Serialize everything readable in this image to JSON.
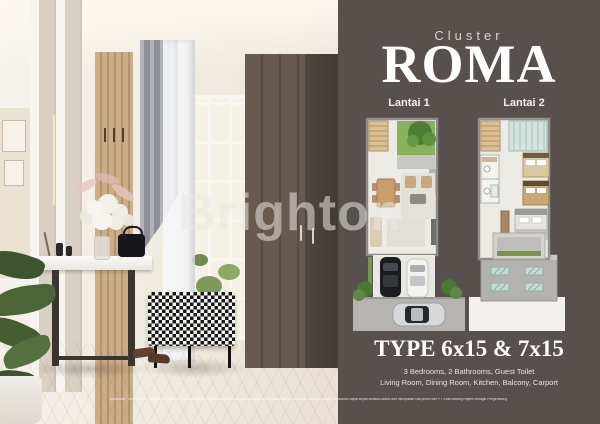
{
  "colors": {
    "panel_bg": "#57504d",
    "title_color": "#ffffff",
    "muted_label": "#d8d3ce",
    "garden_green": "#6f9a4c",
    "floor_wood": "#ddc9a2"
  },
  "watermark": {
    "text": "Brighton"
  },
  "panel": {
    "cluster_label": "Cluster",
    "cluster_name": "ROMA",
    "floors": [
      {
        "label": "Lantai 1"
      },
      {
        "label": "Lantai 2"
      }
    ],
    "type_title": "TYPE 6x15 & 7x15",
    "details": [
      "3 Bedrooms, 2 Bathrooms, Guest Toilet",
      "Living Room, Dining Room, Kitchen, Balcony, Carport"
    ]
  },
  "disclaimer": "Disclaimer : Materi-materi yang tertera di dalam Presentasi ini telah dipersiapkan sebaik-baiknya berdasarkan situasi dan kondisi pada masa persiapan. Perubahan dapat terjadi sewaktu-waktu dan merupakan hak penuh dari PT. Kota Bintang Rayehi sebagai Pengembang."
}
